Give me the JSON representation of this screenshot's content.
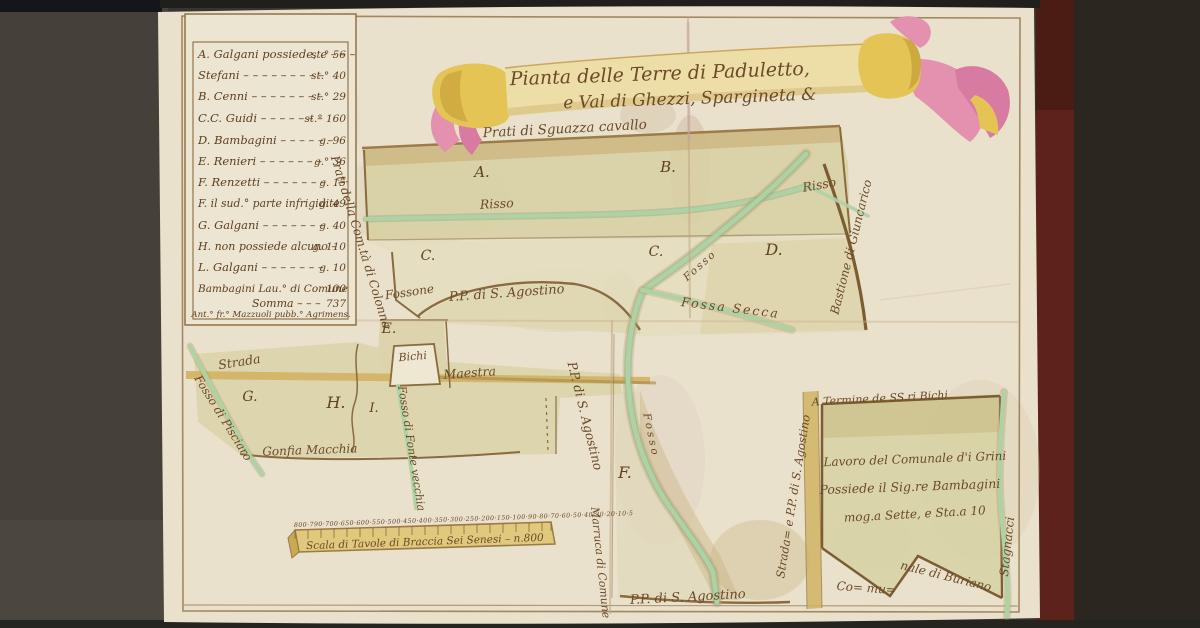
{
  "palette": {
    "paper": "#e9e1cc",
    "ink": "#6b4a28",
    "wash": "#d8d0a4",
    "stream": "#aed2a4",
    "road": "#d1b363",
    "banner_yellow": "#e3c455",
    "banner_pink": "#e391ae",
    "table_maroon": "#5d231a"
  },
  "banner": {
    "title_line1": "Pianta delle Terre di Paduletto,",
    "title_line2": "e Val di Ghezzi, Spargineta &"
  },
  "legend": {
    "rows": [
      {
        "label": "A. Galgani possiede, e – – –",
        "value": "st.° 56"
      },
      {
        "label": "Stefani – – – – – – – – –",
        "value": "st.° 40"
      },
      {
        "label": "B. Cenni – – – – – – – –",
        "value": "st.° 29"
      },
      {
        "label": "C.C. Guidi – – – – – – –",
        "value": "st.° 160"
      },
      {
        "label": "D. Bambagini – – – – – –",
        "value": "g. 96"
      },
      {
        "label": "E. Renieri – – – – – – –",
        "value": "g.° 36"
      },
      {
        "label": "F. Renzetti – – – – – – –",
        "value": "g. 15"
      },
      {
        "label": "F. il sud.° parte infrigidite",
        "value": "g. 49"
      },
      {
        "label": "G. Galgani – – – – – – –",
        "value": "g. 40"
      },
      {
        "label": "H. non possiede alcuno –",
        "value": "g. 110"
      },
      {
        "label": "L. Galgani – – – – – – –",
        "value": "g. 10"
      },
      {
        "label": "Bambagini Lau.° di Comune",
        "value": "100"
      },
      {
        "label": "Somma – – –",
        "value": "737"
      }
    ],
    "signature": "Ant.° fr.° Mazzuoli pubb.° Agrimens."
  },
  "regions": {
    "a": "A.",
    "b": "B.",
    "c_left": "C.",
    "c_right": "C.",
    "d": "D.",
    "e": "E.",
    "f": "F.",
    "g": "G.",
    "h": "H.",
    "i": "I."
  },
  "labels": {
    "prati_sguazza": "Prati di Sguazza cavallo",
    "risso_left": "Risso",
    "risso_right": "Risso",
    "fosso_upper": "Fosso",
    "fossa_secca": "Fossa Secca",
    "bastione": "Bastione di Giuncarico",
    "prati_colonna": "Prati della Com.tà di Colonna",
    "fossone": "Fossone",
    "pp_agostino": "P.P. di S. Agostino",
    "bichi": "Bichi",
    "strada": "Strada",
    "maestra": "Maestra",
    "fosso_pisciaro": "Fosso di Pisciaro",
    "gonfia_macchia": "Gonfia Macchia",
    "fosso_fontevecchia": "Fosso di Fonte vecchia",
    "pp_agostino_vert": "P.P. di S. Agostino",
    "fosso_lower": "Fosso",
    "marruca_comune": "Marruca di Comune",
    "pp_agostino_bottom": "P.P. di S. Agostino",
    "strada_pp_vert": "Strada= e P.P. di S. Agostino",
    "termine_bichi": "A Termine de SS.ri Bichi",
    "lavoro_1": "Lavoro del Comunale d'i Grini",
    "lavoro_2": "Possiede il Sig.re Bambagini",
    "lavoro_3": "mog.a Sette, e Sta.a 10",
    "comunale_1": "Co= mu=",
    "comunale_2": "nale di Buriano",
    "stagnacci": "Stagnacci"
  },
  "scale_bar": {
    "numbers": "800·790·700·650·600·550·500·450·400·350·300·250·200·150·100·90·80·70·60·50·40·30·20·10·5",
    "caption": "Scala di Tavole di Braccia Sei Senesi – n.800"
  }
}
